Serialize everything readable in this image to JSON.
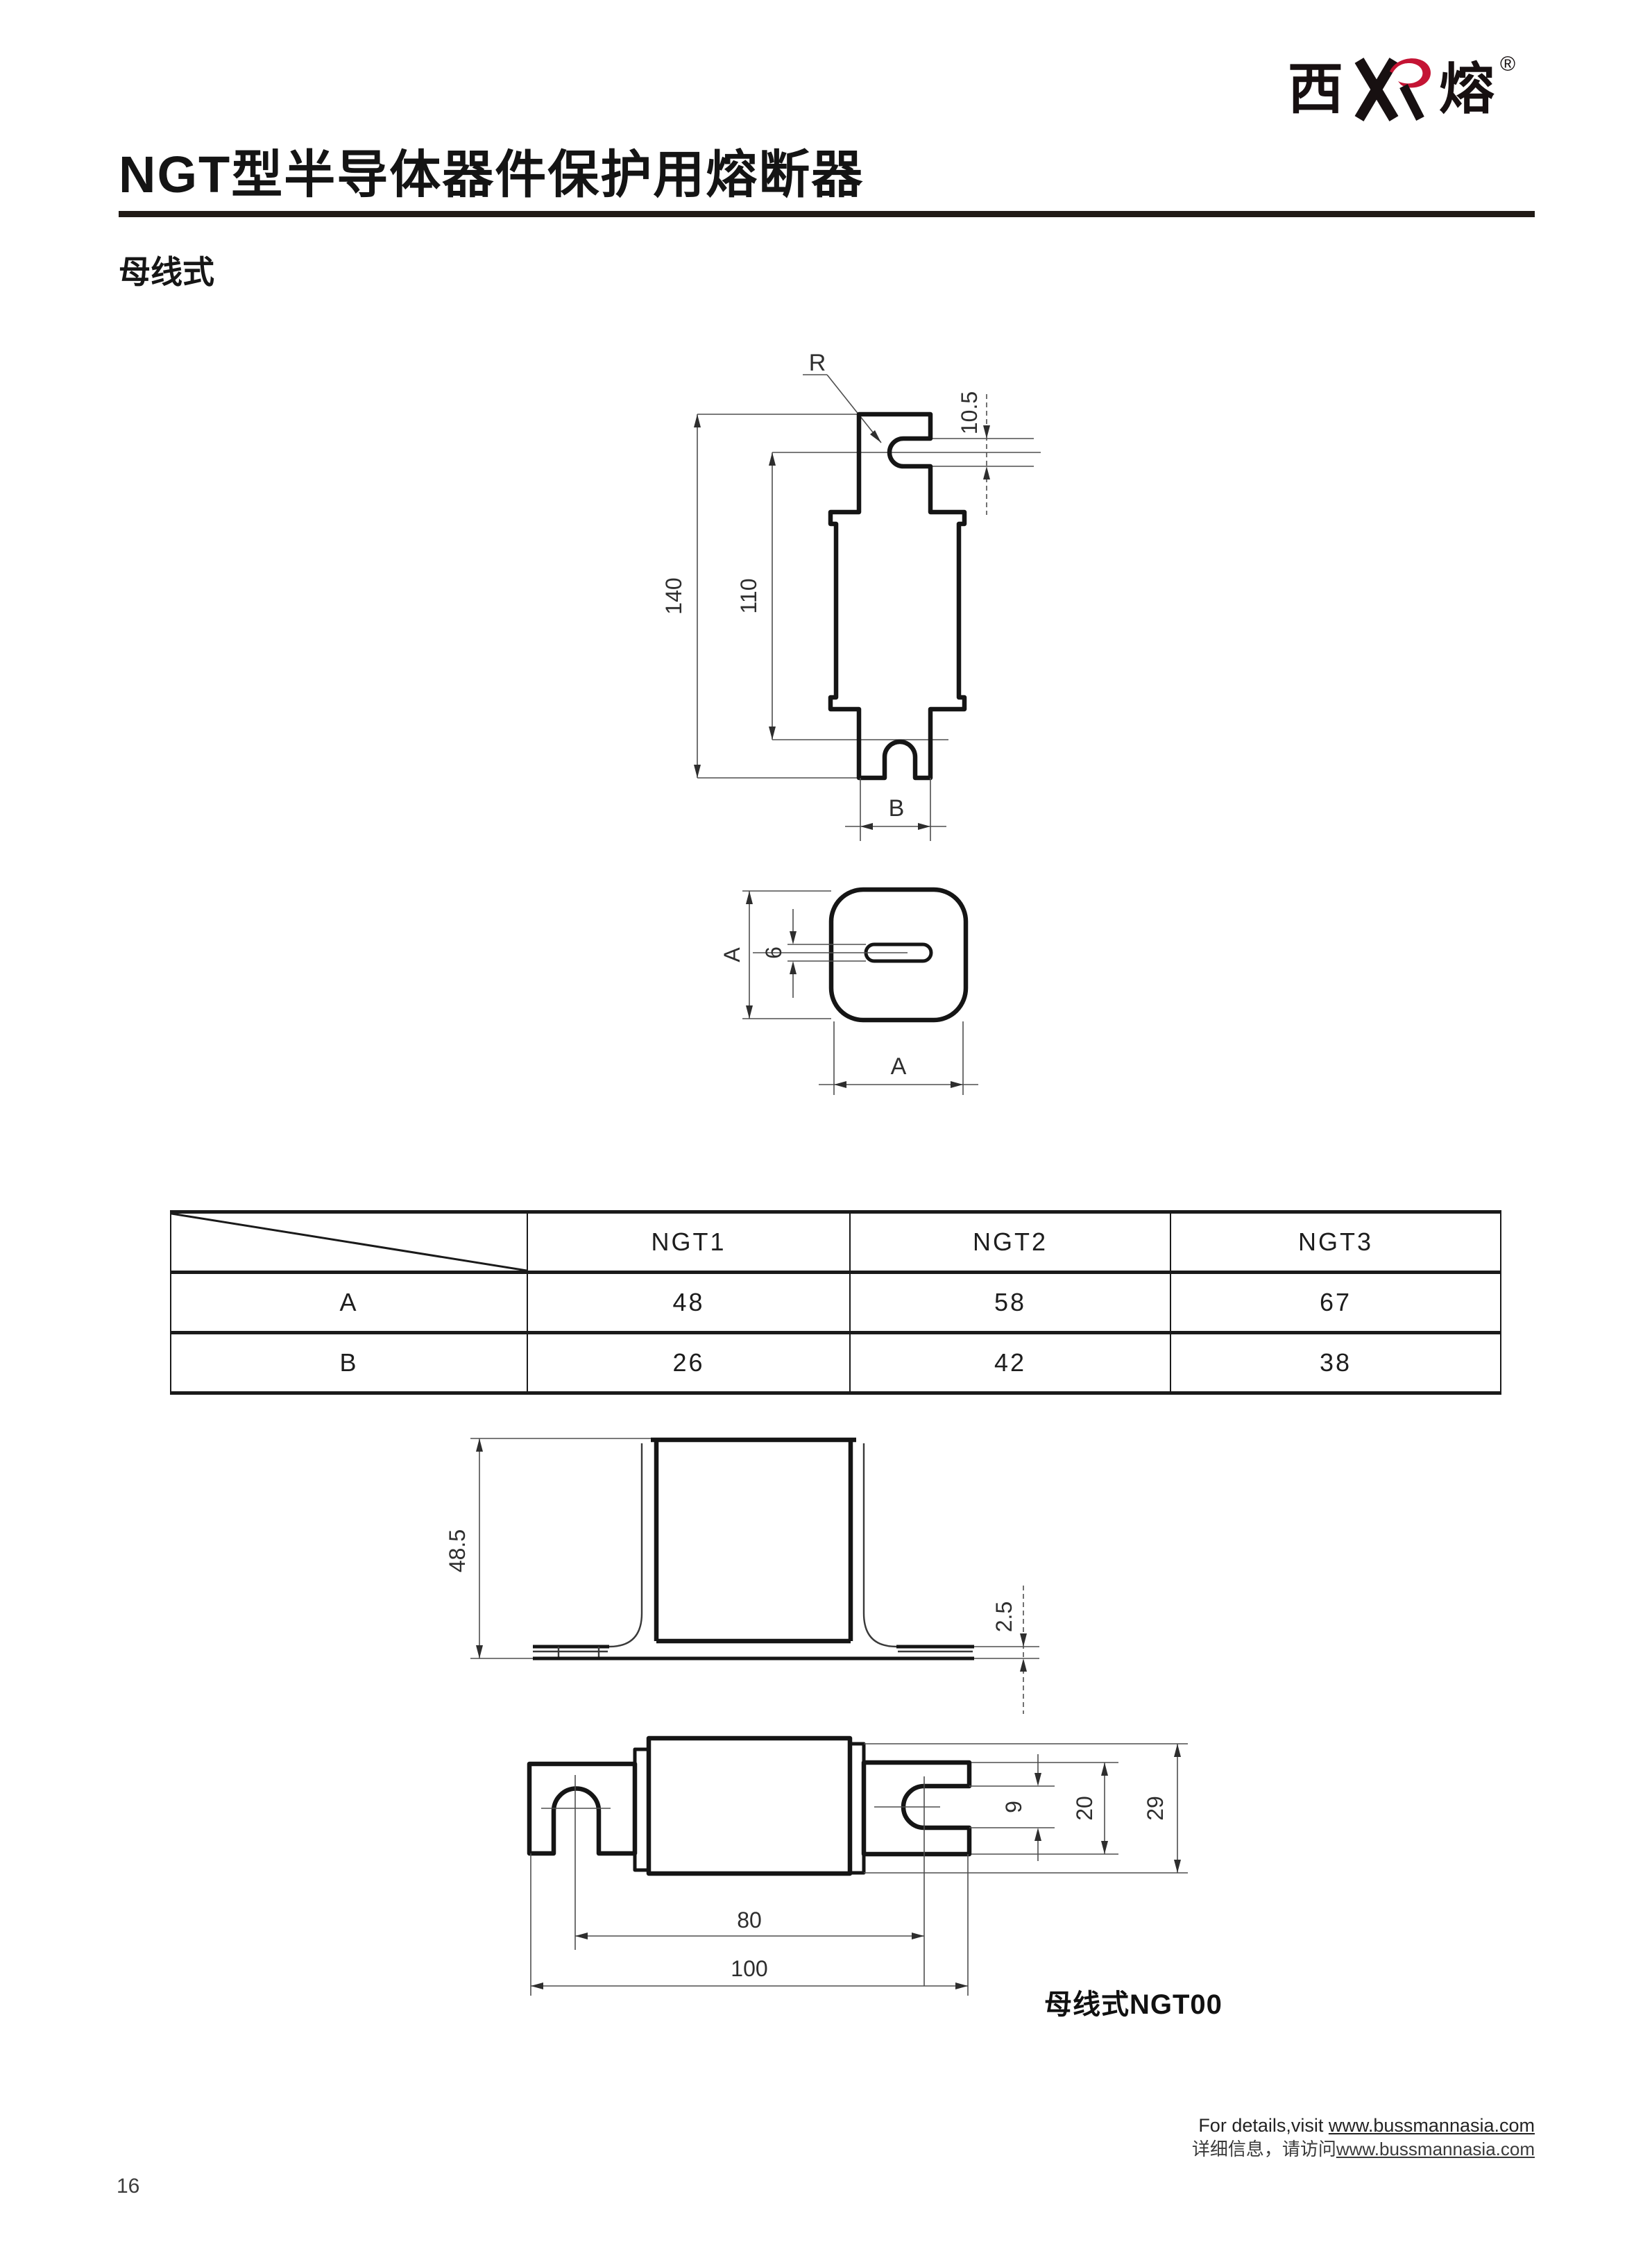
{
  "logo": {
    "cn_left": "西",
    "cn_right": "熔",
    "registered": "®",
    "accent_color": "#c41434"
  },
  "header": {
    "title": "NGT型半导体器件保护用熔断器",
    "subtitle": "母线式"
  },
  "side_view": {
    "radius_label": "R",
    "notch_height": "10.5",
    "total_height": "140",
    "inner_height": "110",
    "blade_width_label": "B"
  },
  "top_view": {
    "width_label_left": "A",
    "slot_width": "6",
    "width_label_bottom": "A"
  },
  "bracket_view": {
    "height": "48.5",
    "plate_thickness": "2.5"
  },
  "busbar_view": {
    "slot_height": "9",
    "blade_height": "20",
    "end_height": "29",
    "hole_spacing": "80",
    "total_length": "100",
    "caption": "母线式NGT00"
  },
  "table": {
    "col_headers": [
      "NGT1",
      "NGT2",
      "NGT3"
    ],
    "rows": [
      {
        "label": "A",
        "values": [
          "48",
          "58",
          "67"
        ]
      },
      {
        "label": "B",
        "values": [
          "26",
          "42",
          "38"
        ]
      }
    ]
  },
  "footer": {
    "line1_prefix": "For details,visit ",
    "line1_url": "www.bussmannasia.com",
    "line2_prefix": "详细信息，请访问",
    "line2_url": "www.bussmannasia.com"
  },
  "page": {
    "number": "16"
  }
}
